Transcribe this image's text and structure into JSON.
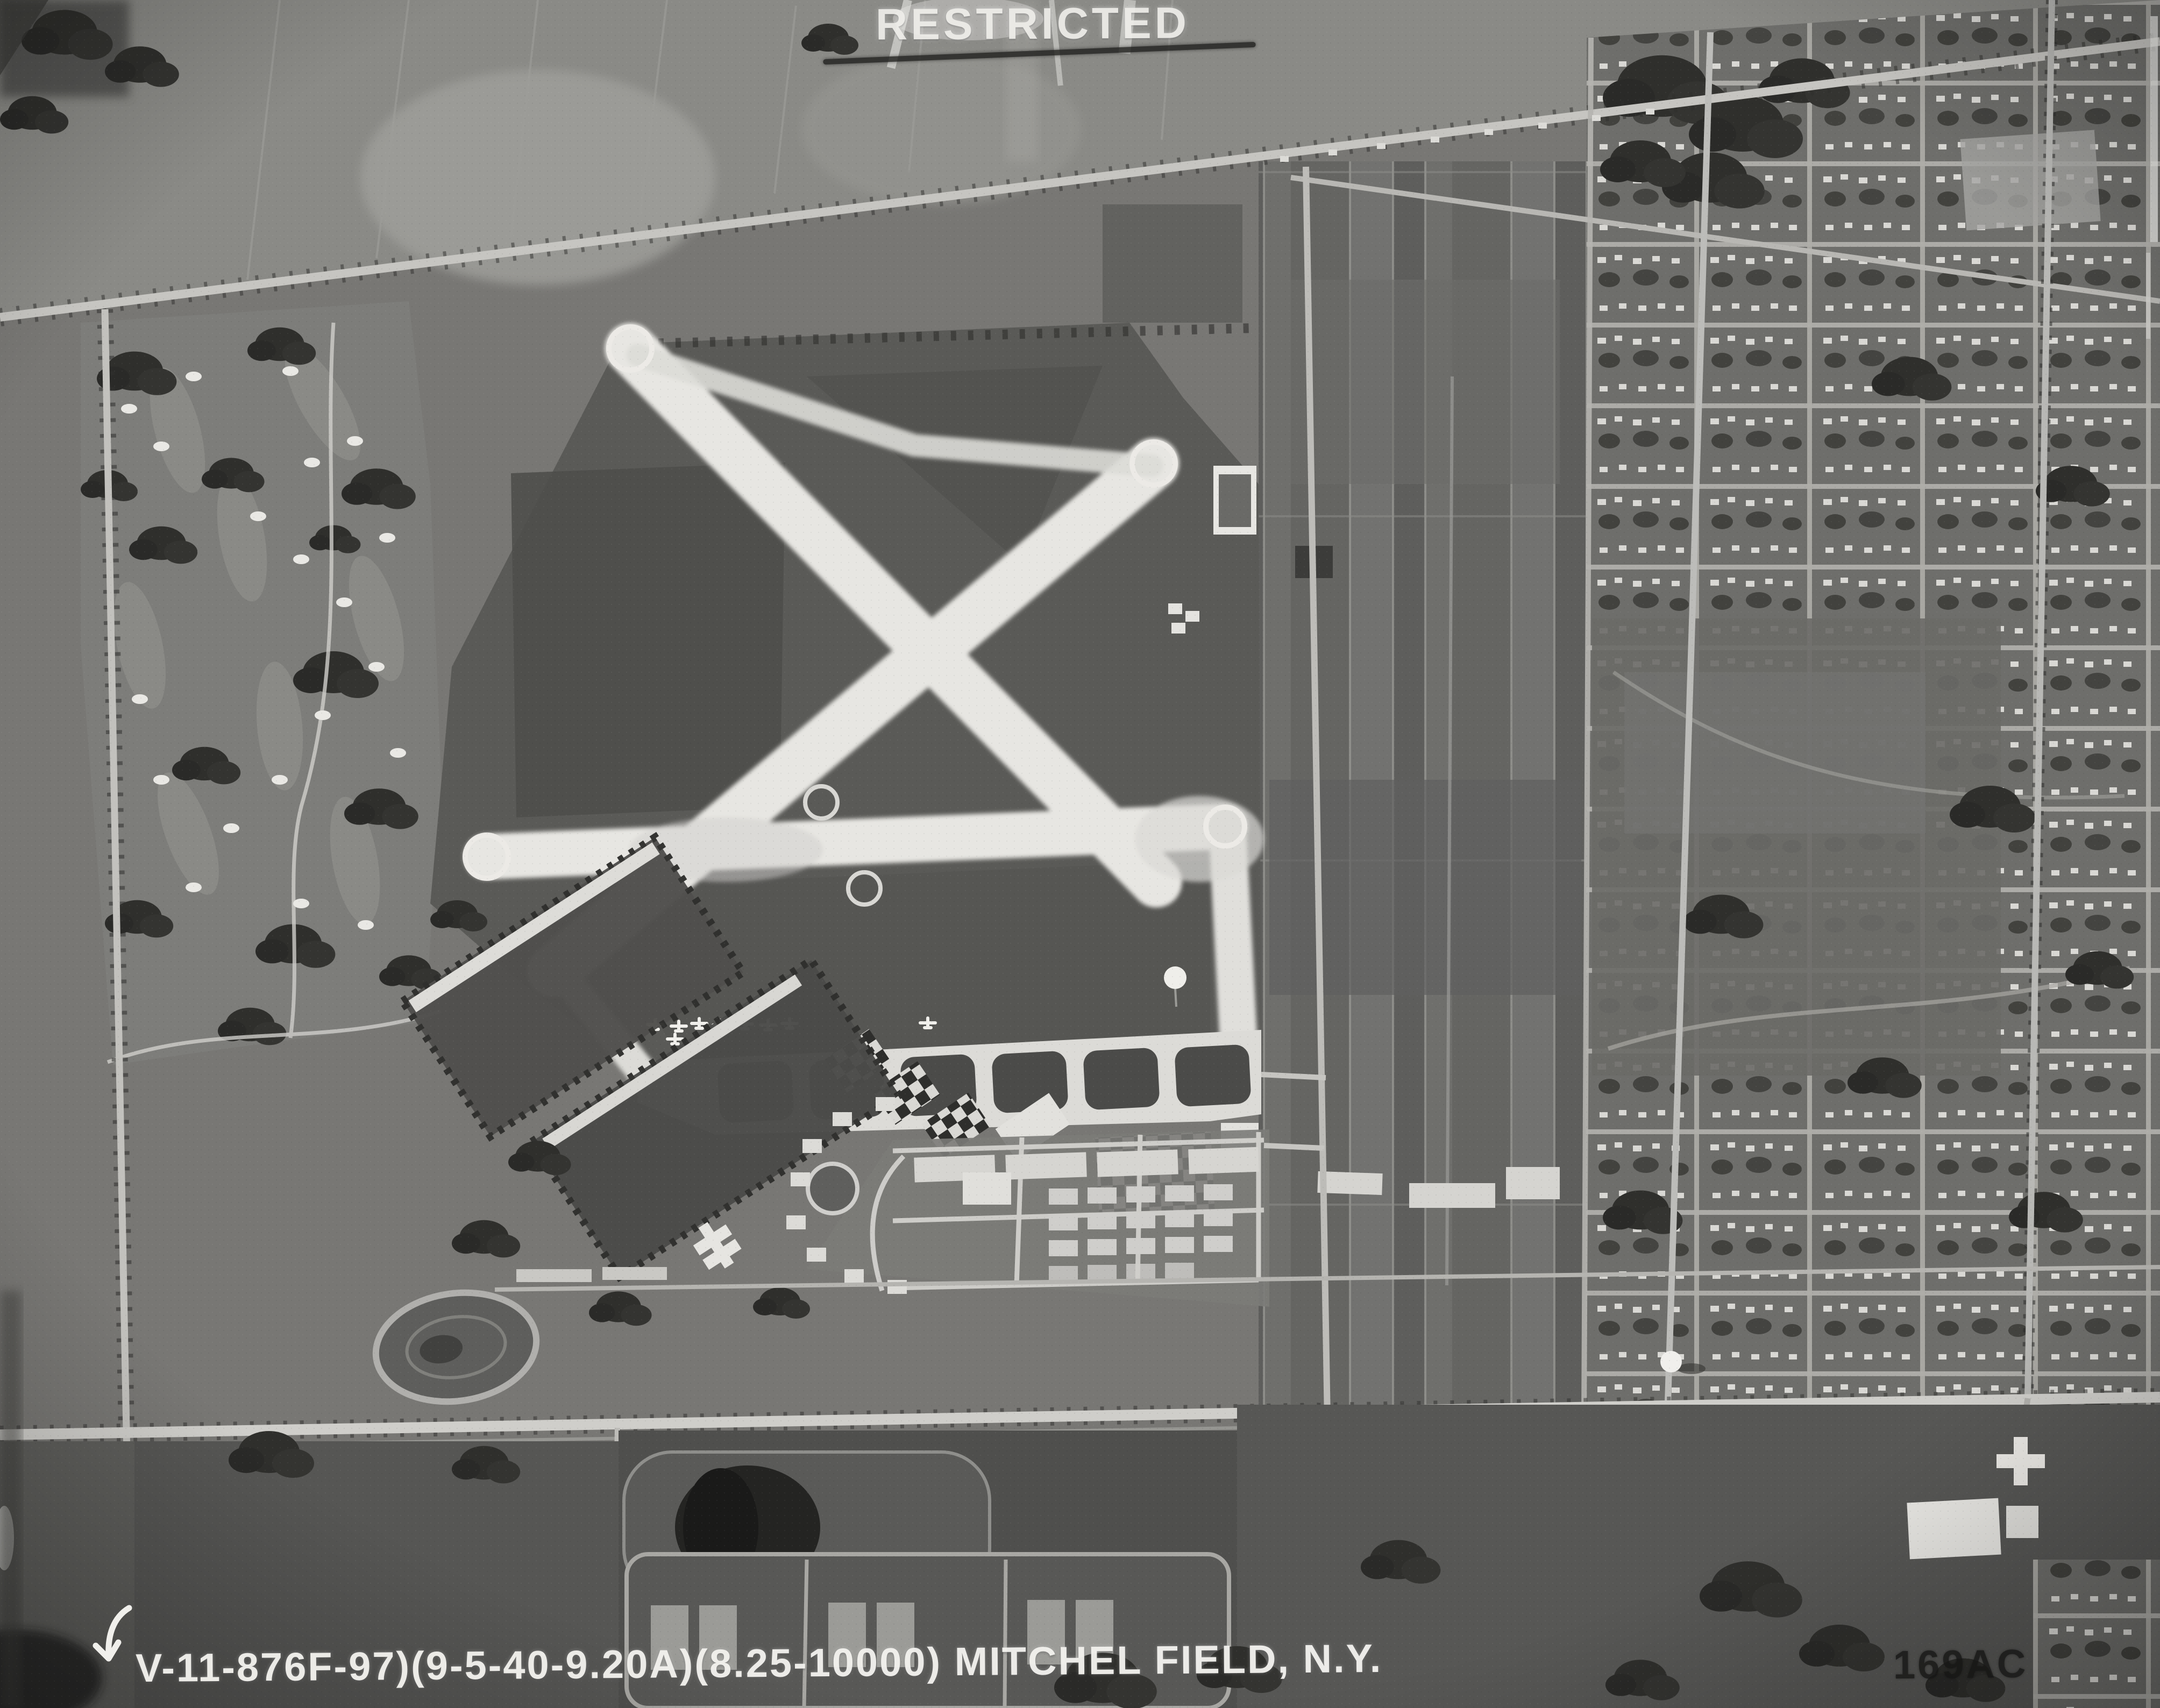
{
  "photo": {
    "description": "black-and-white vertical aerial photograph of an airfield and surrounding suburbs",
    "classification_stamp": "RESTRICTED",
    "classification_struck_out": true,
    "caption_line": "V-11-876F-97)(9-5-40-9.20A)(8.25-10000) MITCHEL FIELD, N.Y.",
    "negative_number": "169AC",
    "index_arrow_icon": "down-left-arrow"
  },
  "palette": {
    "paper_white": "#f0efec",
    "runway_white": "#e7e6e2",
    "light_gray": "#b6b6b3",
    "mid_gray": "#787774",
    "field_dark": "#565654",
    "tree_dark": "#2d2d2b",
    "ink_dark": "#161615"
  },
  "landmarks": [
    "crossed-runways",
    "east-west-runway",
    "taxiways",
    "hangar-apron",
    "checkerboard-hangar-roofs",
    "parked-aircraft",
    "base-barracks-grid",
    "curved-officer-housing",
    "polo-athletic-fields",
    "golf-course",
    "suburban-street-grid",
    "farm-field-strips",
    "main-diagonal-road",
    "highway",
    "railroad-line",
    "racetrack-oval",
    "dark-pond",
    "water-tower",
    "hospital-cross-building",
    "tennis-courts"
  ]
}
